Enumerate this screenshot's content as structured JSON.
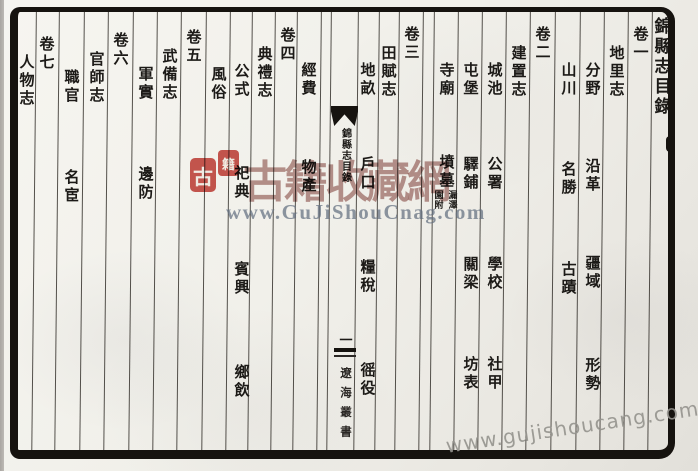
{
  "page": {
    "title": "錦縣志目錄",
    "columns": [
      {
        "x": 661,
        "items": [
          {
            "t": "錦縣志目錄",
            "y": 17,
            "kind": "title"
          }
        ]
      },
      {
        "x": 640,
        "items": [
          {
            "t": "卷一",
            "y": 26,
            "kind": "volume"
          }
        ]
      },
      {
        "x": 616,
        "items": [
          {
            "t": "地里志",
            "y": 45,
            "kind": "section"
          }
        ]
      },
      {
        "x": 592,
        "items": [
          {
            "t": "分野",
            "y": 62
          },
          {
            "t": "沿革",
            "y": 158
          },
          {
            "t": "疆域",
            "y": 255
          },
          {
            "t": "形勢",
            "y": 357
          }
        ]
      },
      {
        "x": 568,
        "items": [
          {
            "t": "山川",
            "y": 62
          },
          {
            "t": "名勝",
            "y": 161
          },
          {
            "t": "古蹟",
            "y": 261
          }
        ]
      },
      {
        "x": 542,
        "items": [
          {
            "t": "卷二",
            "y": 26,
            "kind": "volume"
          }
        ]
      },
      {
        "x": 518,
        "items": [
          {
            "t": "建置志",
            "y": 45,
            "kind": "section"
          }
        ]
      },
      {
        "x": 494,
        "items": [
          {
            "t": "城池",
            "y": 62
          },
          {
            "t": "公署",
            "y": 156
          },
          {
            "t": "學校",
            "y": 256
          },
          {
            "t": "社甲",
            "y": 356
          }
        ]
      },
      {
        "x": 470,
        "items": [
          {
            "t": "屯堡",
            "y": 62
          },
          {
            "t": "驛鋪",
            "y": 156
          },
          {
            "t": "關梁",
            "y": 256
          },
          {
            "t": "坊表",
            "y": 356
          }
        ]
      },
      {
        "x": 446,
        "items": [
          {
            "t": "寺廟",
            "y": 62
          },
          {
            "t": "墳墓",
            "y": 154
          },
          {
            "t": "漏澤園附",
            "y": 190,
            "kind": "note",
            "parts": [
              "漏澤",
              "園附"
            ]
          }
        ]
      },
      {
        "x": 411,
        "items": [
          {
            "t": "卷三",
            "y": 26,
            "kind": "volume"
          }
        ]
      },
      {
        "x": 388,
        "items": [
          {
            "t": "田賦志",
            "y": 45,
            "kind": "section"
          }
        ]
      },
      {
        "x": 367,
        "items": [
          {
            "t": "地畝",
            "y": 62
          },
          {
            "t": "戶口",
            "y": 156
          },
          {
            "t": "糧稅",
            "y": 259
          },
          {
            "t": "徭役",
            "y": 362
          }
        ]
      },
      {
        "x": 308,
        "items": [
          {
            "t": "經費",
            "y": 62
          },
          {
            "t": "物產",
            "y": 159
          }
        ]
      },
      {
        "x": 287,
        "items": [
          {
            "t": "卷四",
            "y": 27,
            "kind": "volume"
          }
        ]
      },
      {
        "x": 264,
        "items": [
          {
            "t": "典禮志",
            "y": 46,
            "kind": "section"
          }
        ]
      },
      {
        "x": 241,
        "items": [
          {
            "t": "公式",
            "y": 63
          },
          {
            "t": "祀典",
            "y": 165
          },
          {
            "t": "賓興",
            "y": 261
          },
          {
            "t": "鄉飲",
            "y": 364
          }
        ]
      },
      {
        "x": 218,
        "items": [
          {
            "t": "風俗",
            "y": 66
          }
        ]
      },
      {
        "x": 193,
        "items": [
          {
            "t": "卷五",
            "y": 29,
            "kind": "volume"
          }
        ]
      },
      {
        "x": 169,
        "items": [
          {
            "t": "武備志",
            "y": 48,
            "kind": "section"
          }
        ]
      },
      {
        "x": 145,
        "items": [
          {
            "t": "軍實",
            "y": 66
          },
          {
            "t": "邊防",
            "y": 166
          }
        ]
      },
      {
        "x": 120,
        "items": [
          {
            "t": "卷六",
            "y": 32,
            "kind": "volume"
          }
        ]
      },
      {
        "x": 96,
        "items": [
          {
            "t": "官師志",
            "y": 51,
            "kind": "section"
          }
        ]
      },
      {
        "x": 71,
        "items": [
          {
            "t": "職官",
            "y": 69
          },
          {
            "t": "名宦",
            "y": 169
          }
        ]
      },
      {
        "x": 46,
        "items": [
          {
            "t": "卷七",
            "y": 36,
            "kind": "volume"
          }
        ]
      },
      {
        "x": 26,
        "items": [
          {
            "t": "人物志",
            "y": 54,
            "kind": "section"
          }
        ]
      }
    ],
    "spine": {
      "label": "錦縣志目錄",
      "page_number": "一",
      "series": "遼海叢書"
    },
    "watermarks": {
      "stamp_chars": [
        "古",
        "籍"
      ],
      "brand": "古籍收藏網",
      "center_url": "www.GuJiShouCnag.com",
      "corner_url": "www.gujishoucang.com"
    },
    "colors": {
      "stamp_red": "#c5413a",
      "brand_red": "#7e362f",
      "url_blue_gray": "#636f7f",
      "ink": "#1c1a17"
    }
  }
}
